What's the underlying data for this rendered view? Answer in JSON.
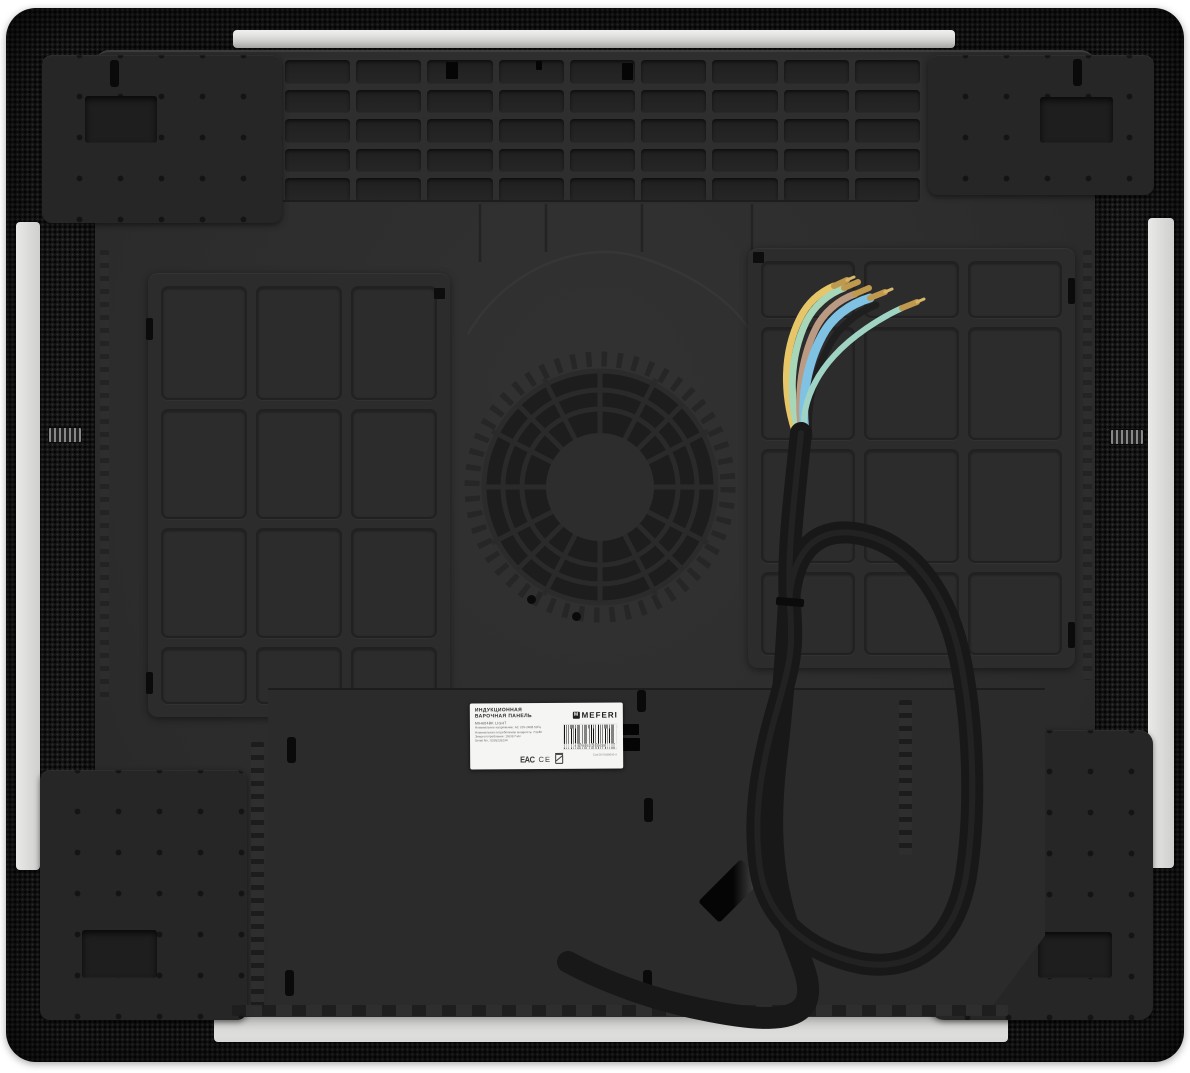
{
  "photo": {
    "subject": "underside of a built-in induction hob with cooling fan, mounting plates and unstripped power cable",
    "background_color": "#ffffff"
  },
  "label": {
    "title_line1": "ИНДУКЦИОННАЯ",
    "title_line2": "ВАРОЧНАЯ ПАНЕЛЬ",
    "model": "MIH604BK LIGHT",
    "specs": {
      "line1": "Номинальное напряжение: AC 220-240В 50Гц",
      "line2": "Номинальная потребляемая мощность: 7.0кВт",
      "line3": "Энергопотребление: 193 Вт*ч/кг",
      "line4": "Serial No.: 0326233234"
    },
    "brand": "MEFERI",
    "brand_icon_letter": "M",
    "brand_tagline": "MAKE YOUR LIFE GREEN",
    "eac_mark": "EAC",
    "ce_mark": "CE",
    "barcode_number": "4 679262 251438",
    "barcode_code": "Cod:0070598656-A"
  },
  "structure": {
    "vent_grille": {
      "cols": 9,
      "rows": 5
    },
    "coil_cover_left": {
      "cols": 3,
      "rows": 4
    },
    "coil_cover_right": {
      "cols": 3,
      "rows": 4
    }
  },
  "colors": {
    "carbon_frame": "#141414",
    "pan_metal": "#2d2d2d",
    "glass_edge": "#e6e6e4",
    "cable_sheath": "#181818",
    "wire_yellow": "#e6c668",
    "wire_green": "#a7d6b8",
    "wire_brown": "#bb9a83",
    "wire_blue": "#7fc2e4",
    "wire_black": "#1f1f1f",
    "ferrule_brass": "#bf9a4e"
  }
}
